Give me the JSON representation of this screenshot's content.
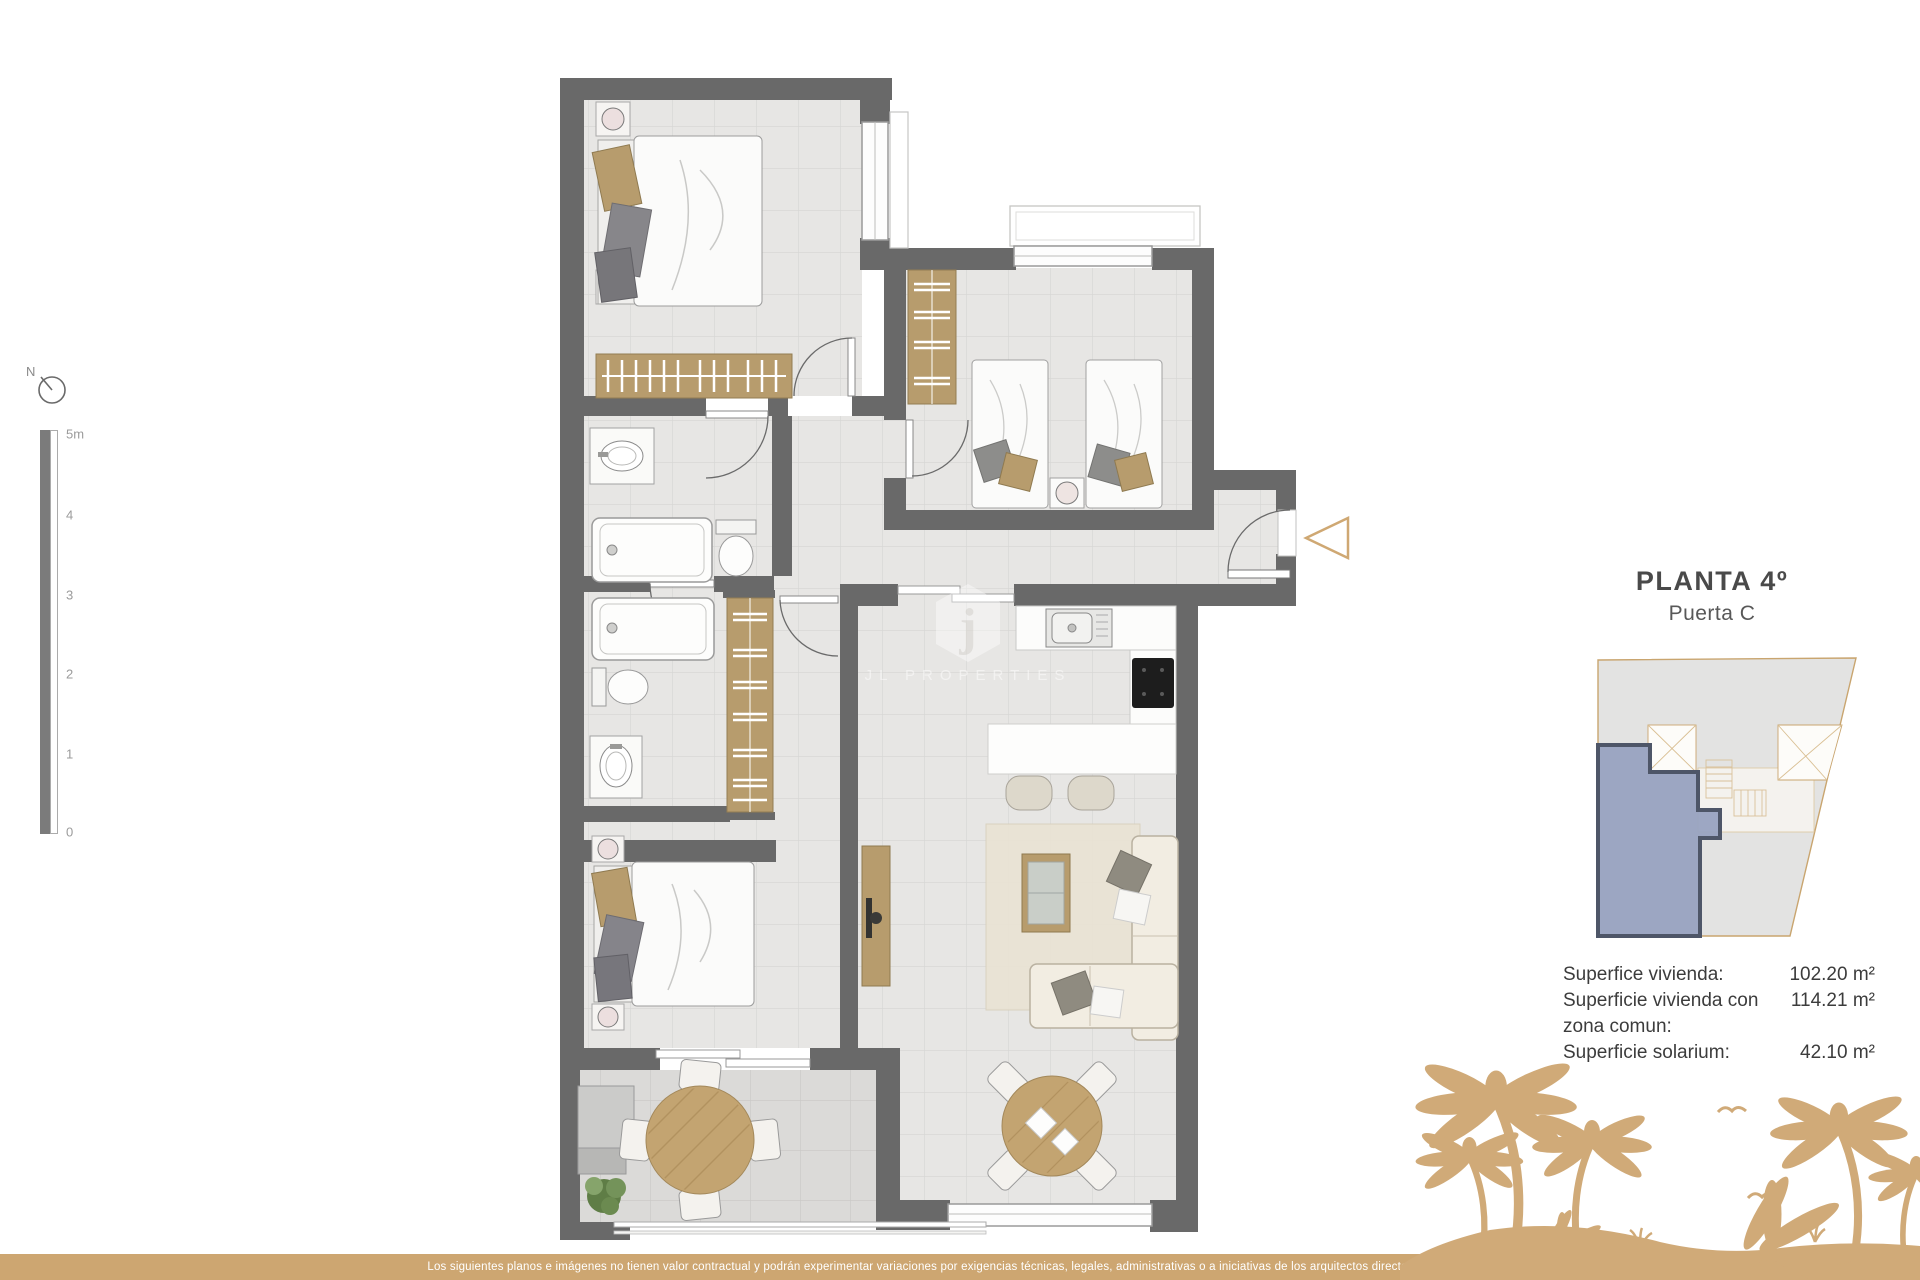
{
  "north": {
    "label": "N"
  },
  "scale": {
    "top": "5m",
    "ticks": [
      "4",
      "3",
      "2",
      "1",
      "0"
    ]
  },
  "plan": {
    "title": "PLANTA 4º",
    "subtitle": "Puerta C"
  },
  "areas": [
    {
      "label": "Superfice vivienda:",
      "value": "102.20 m²"
    },
    {
      "label": "Superficie vivienda con zona comun:",
      "value": "114.21 m²"
    },
    {
      "label": "Superficie solarium:",
      "value": "42.10 m²"
    }
  ],
  "watermark": {
    "badge_letter": "j",
    "brand": "JL PROPERTIES"
  },
  "disclaimer": "Los siguientes planos e imágenes no tienen valor contractual y podrán experimentar variaciones por exigencias técnicas, legales, administrativas o a iniciativas de los arquitectos directores de las obras",
  "colors": {
    "accent_tan": "#d0aa78",
    "bar_tan": "#cda671",
    "wall_gray": "#696969",
    "unit_highlight_blue": "#98a2c0"
  }
}
